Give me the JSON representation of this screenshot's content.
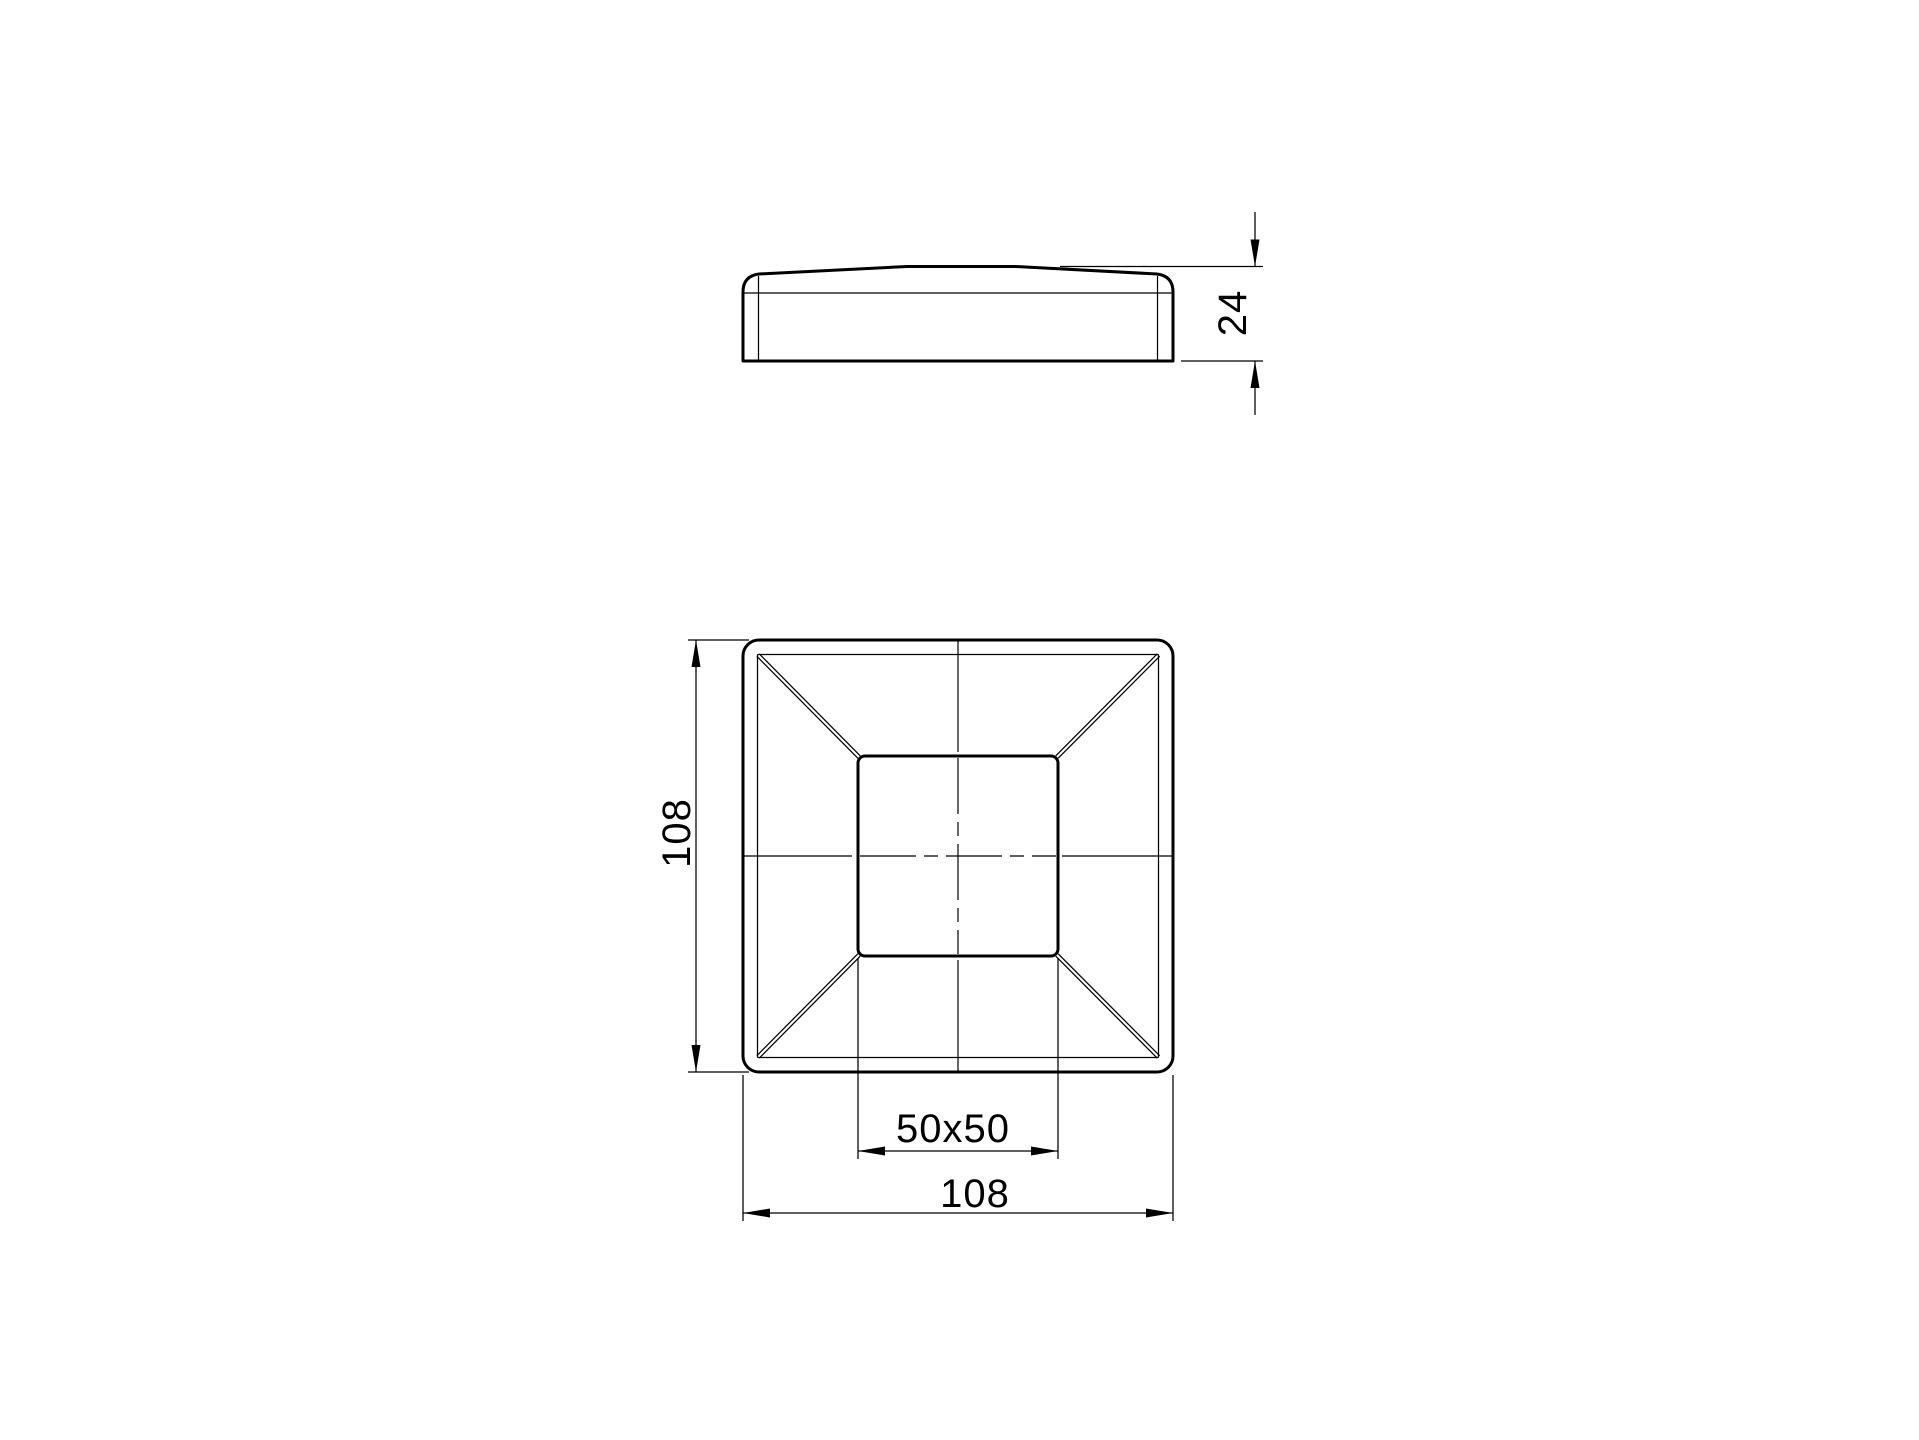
{
  "page": {
    "background": "#ffffff",
    "ink": "#000000"
  },
  "drawing": {
    "dimensions": {
      "cap_height": {
        "label": "24",
        "orientation": "vertical"
      },
      "plan_height": {
        "label": "108",
        "orientation": "vertical"
      },
      "post_section": {
        "label": "50x50",
        "orientation": "horizontal"
      },
      "plan_width": {
        "label": "108",
        "orientation": "horizontal"
      }
    }
  }
}
